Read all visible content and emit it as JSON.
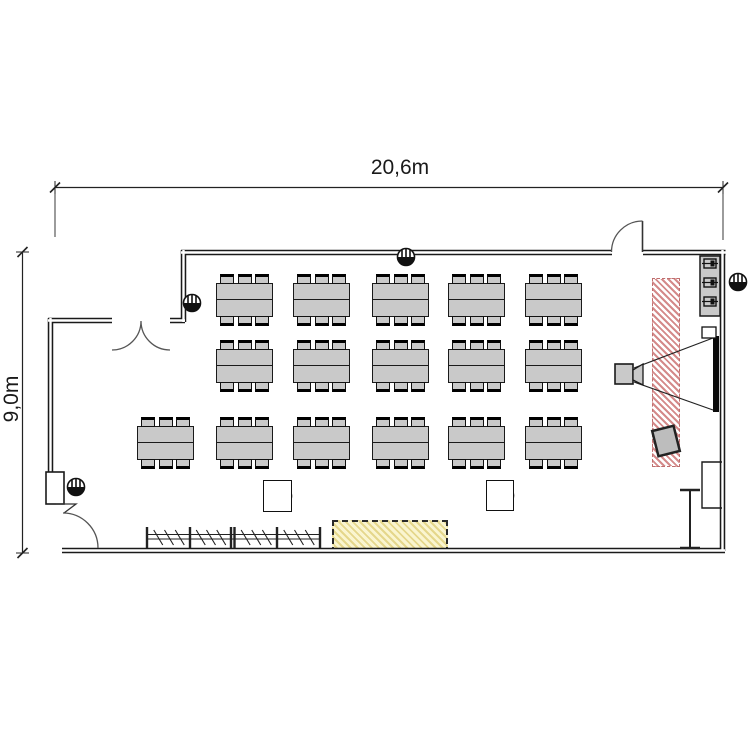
{
  "labels": {
    "room_width": "20,6m",
    "room_height": "9,0m"
  },
  "colors": {
    "furniture_fill": "#c9c9c9",
    "furniture_outline": "#1a1a1a",
    "wall": "#1a1a1a",
    "projection_zone_stripe": "#d48a8a",
    "reserved_zone_stripe": "#e5d78c",
    "screen": "#0a0a0a"
  },
  "floorplan": {
    "seats_per_table": 6,
    "table_size": {
      "w": 57,
      "h": 34
    },
    "chair_size": {
      "w": 14,
      "h": 10
    },
    "table_rows": [
      {
        "id": "table-row-1",
        "y": 283,
        "x_positions": [
          216,
          293,
          372,
          448,
          525
        ]
      },
      {
        "id": "table-row-2",
        "y": 349,
        "x_positions": [
          216,
          293,
          372,
          448,
          525
        ]
      },
      {
        "id": "table-row-3",
        "y": 426,
        "x_positions": [
          137,
          216,
          293,
          372,
          448,
          525
        ]
      }
    ],
    "zones": [
      {
        "id": "projection-zone",
        "style": "red-hatch",
        "x": 652,
        "y": 278,
        "w": 28,
        "h": 189
      },
      {
        "id": "reserved-zone",
        "style": "yellow-hatch",
        "x": 332,
        "y": 520,
        "w": 116,
        "h": 33
      }
    ],
    "floor_boxes": [
      {
        "x": 263,
        "y": 480,
        "w": 29,
        "h": 32
      },
      {
        "x": 486,
        "y": 480,
        "w": 28,
        "h": 31
      }
    ],
    "utility_markers": [
      {
        "x": 76,
        "y": 487
      },
      {
        "x": 192,
        "y": 303
      },
      {
        "x": 406,
        "y": 257
      },
      {
        "x": 738,
        "y": 282
      }
    ],
    "equipment": {
      "projector": {
        "x": 615,
        "y": 364,
        "w": 18,
        "h": 20
      },
      "screen": {
        "x": 713,
        "y": 336,
        "w": 6,
        "h": 76
      },
      "cone": {
        "top": [
          634,
          368,
          713,
          338
        ],
        "bottom": [
          634,
          382,
          713,
          410
        ]
      },
      "sideboard": {
        "x": 700,
        "y": 256,
        "w": 20,
        "h": 60,
        "device_count": 3
      },
      "wall_box": {
        "x": 702,
        "y": 327,
        "w": 14,
        "h": 11
      },
      "flipchart": {
        "cx": 666,
        "cy": 441,
        "w": 22,
        "h": 26,
        "angle": -14
      },
      "radiator": {
        "x": 690,
        "y1": 490,
        "y2": 548,
        "cap_half": 10
      },
      "coat_rack": {
        "x1": 147,
        "x2": 320,
        "y": 537,
        "posts": [
          147,
          190,
          231,
          234.5,
          277,
          320
        ],
        "hooks_per_bay": 3
      }
    }
  }
}
